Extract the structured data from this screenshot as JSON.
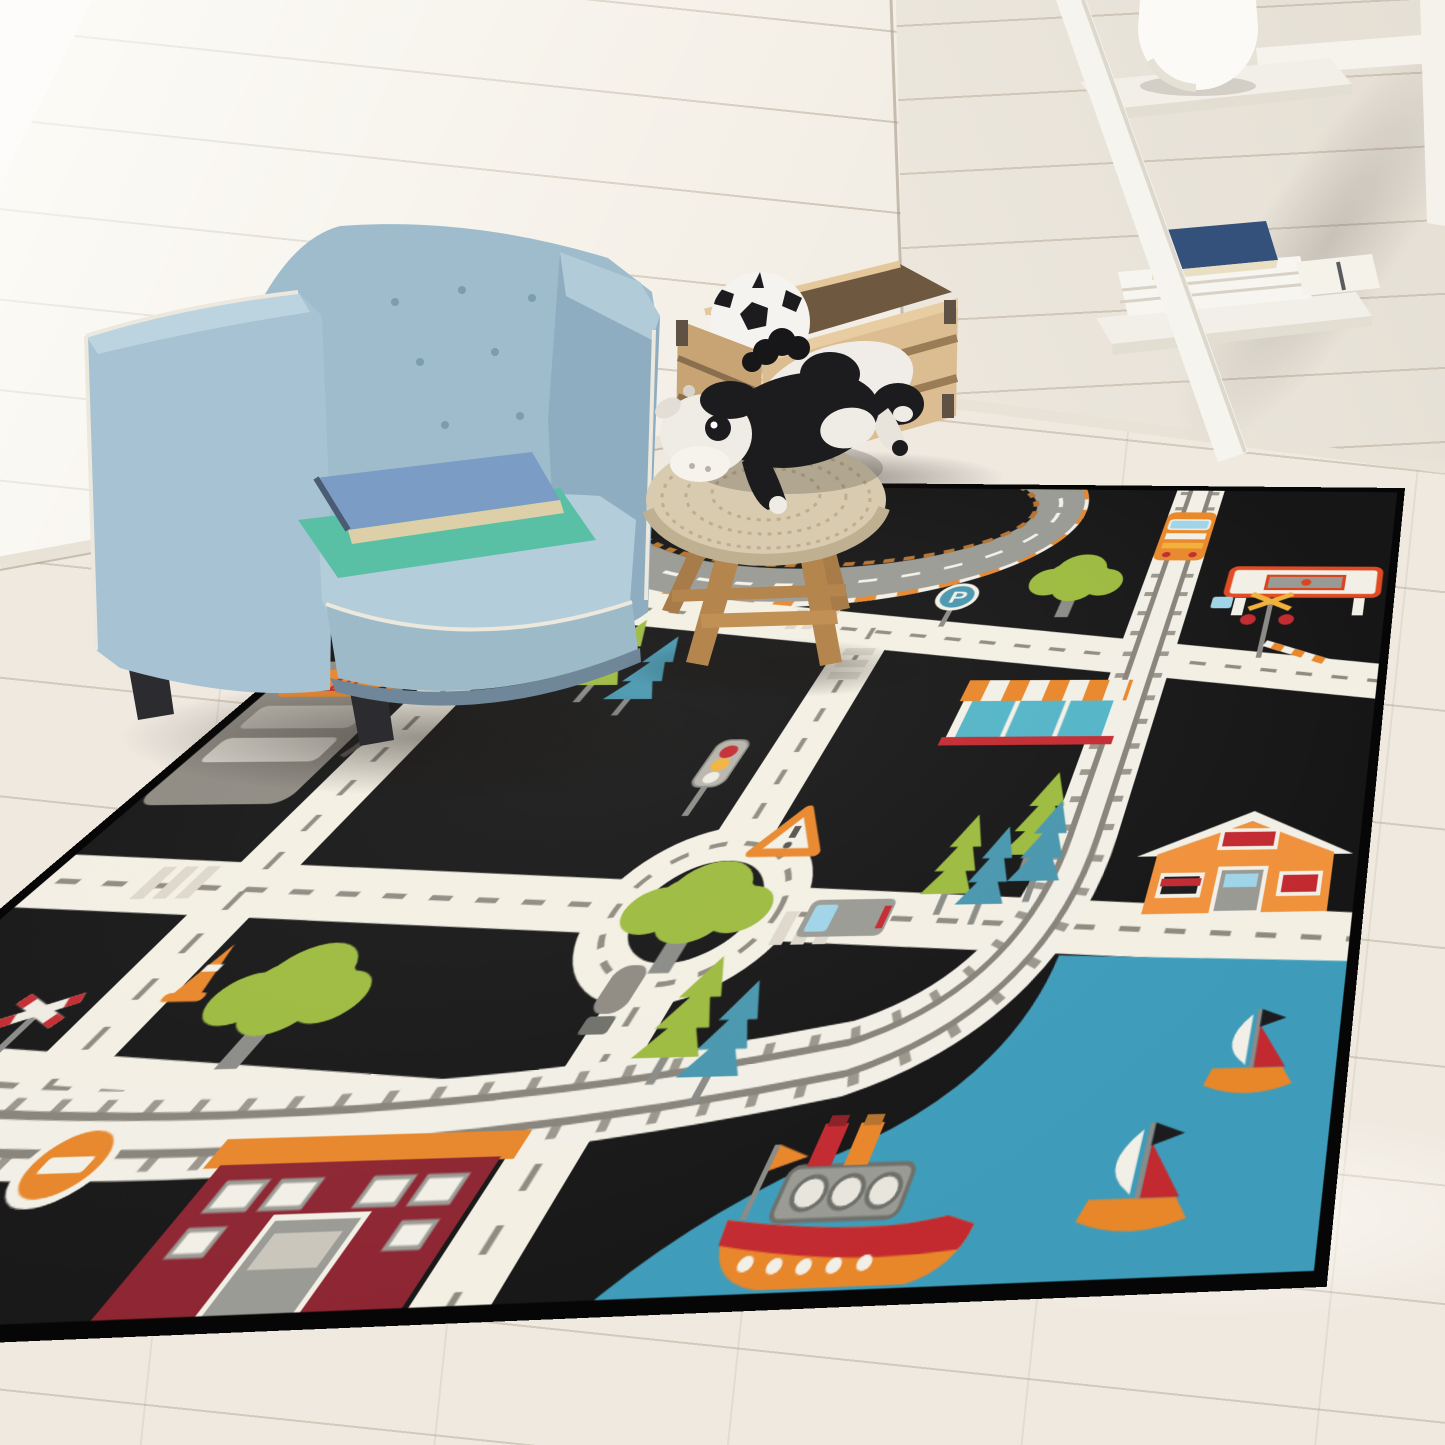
{
  "scene": {
    "type": "photograph",
    "setting": "children's playroom corner",
    "wall": "white shiplap panels",
    "floor": "whitewashed wood planks",
    "lighting": "daylight from upper left window"
  },
  "palette": {
    "rug_black": "#161616",
    "road_white": "#f3efe3",
    "road_dash": "#8e8a80",
    "water_blue": "#3e9cba",
    "grass_green": "#9cba3e",
    "pine_blue": "#4796ae",
    "accent_orange": "#e8862a",
    "accent_red": "#c22a30",
    "icon_gray": "#9a9a94",
    "chair_blue": "#9fbccc",
    "crate_wood": "#d8b88c",
    "stool_wood": "#b5854e",
    "crochet_beige": "#d9cbb0",
    "wall_white": "#f3eee5",
    "floor_wood": "#efe9e0"
  },
  "furniture": {
    "armchair": {
      "style": "tufted cube kids chair",
      "color_name": "light slate blue",
      "piping": "white",
      "books_on_seat": [
        "blue hardcover book",
        "mint green folder"
      ]
    },
    "stool": {
      "seat": "beige crochet pouf",
      "legs": "natural oak, splayed",
      "toys_on_top": [
        "plush holstein cow",
        "plush holstein cow"
      ]
    },
    "toy_crate": {
      "material": "natural pine slats",
      "hardware": "metal corner brackets",
      "contents": [
        "black and white soccer ball"
      ]
    },
    "ladder_shelf": {
      "color": "white",
      "top_shelf_items": [
        "round white vase"
      ],
      "lower_shelf_items": [
        "navy blue hardcover book",
        "stack of white books",
        "white book with bookmark"
      ]
    }
  },
  "rug": {
    "type": "kids city road play rug",
    "shape": "rectangle seen in perspective",
    "border": "black binding",
    "labels": {
      "gas_pump": "19",
      "parking_sign": "P"
    },
    "features": [
      "race track oval with orange-white striped curb",
      "parking sign",
      "traffic light",
      "roundabout with large tree",
      "gas pump",
      "warning triangle sign",
      "railroad crossbuck signs",
      "traffic cone",
      "no-entry sign",
      "dark red school building",
      "leafy green trees",
      "green and blue pine trees",
      "white roads with dashed center lines",
      "crosswalks",
      "train track with 90-degree curve",
      "orange train engine",
      "gas station canopy",
      "railroad crossing signal with striped barrier",
      "shop with orange striped awning",
      "gray delivery truck",
      "small gray tanker truck",
      "orange house with white roof",
      "blue harbor water",
      "steamboat with two funnels",
      "sailboats"
    ],
    "counts": {
      "sailboats": 2,
      "steamboats": 1,
      "trains": 1,
      "buildings": 3,
      "trees": 12
    }
  }
}
